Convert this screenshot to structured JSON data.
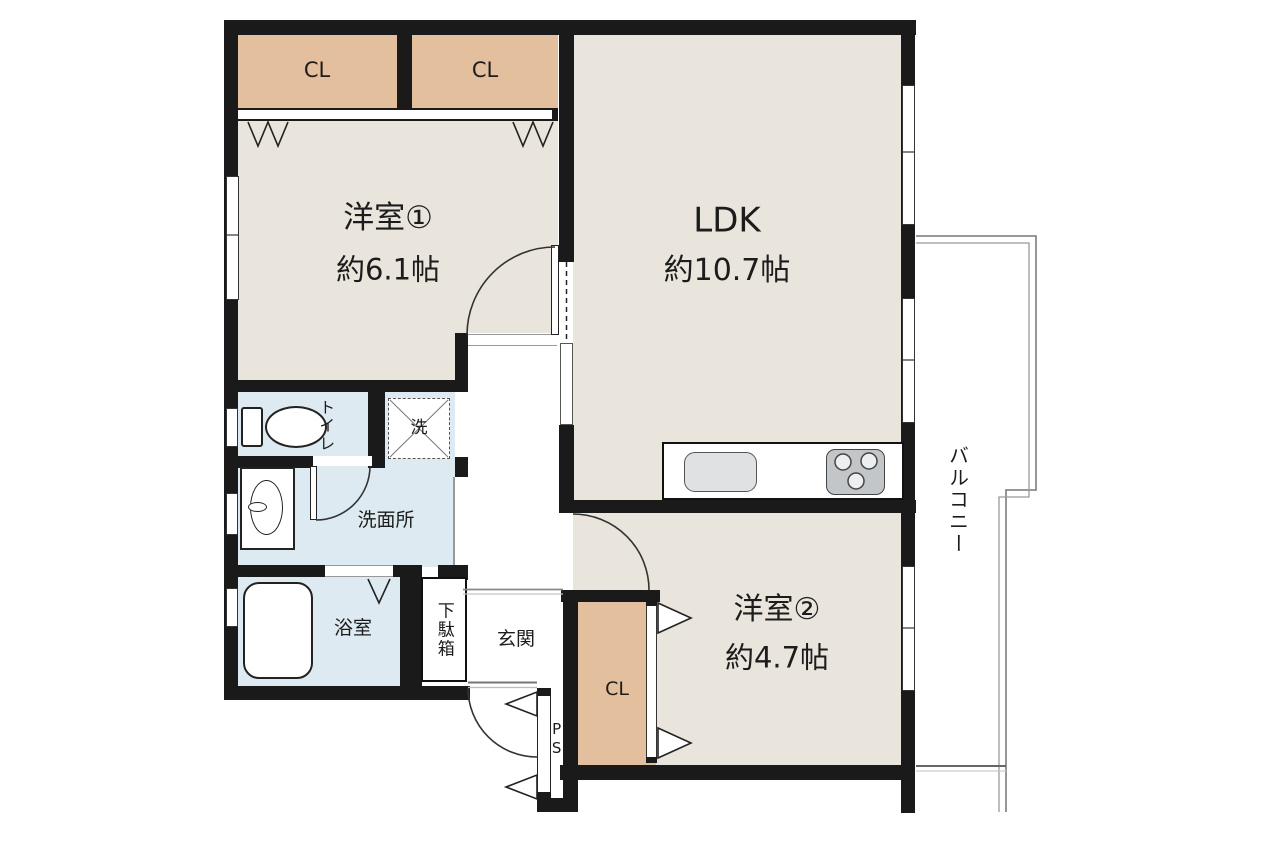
{
  "plan": {
    "rooms": {
      "yoshitsu1": {
        "name": "洋室①",
        "size": "約6.1帖"
      },
      "ldk": {
        "name": "LDK",
        "size": "約10.7帖"
      },
      "yoshitsu2": {
        "name": "洋室②",
        "size": "約4.7帖"
      },
      "toilet": {
        "name": "トイレ"
      },
      "washroom": {
        "name": "洗面所"
      },
      "bathroom": {
        "name": "浴室"
      },
      "entrance": {
        "name": "玄関"
      },
      "balcony": {
        "name": "バルコニー"
      }
    },
    "storage": {
      "closet1": "CL",
      "closet2": "CL",
      "closet3": "CL",
      "shoe_cabinet": "下駄箱",
      "pipe_space": "PS",
      "washer_pan": "洗"
    },
    "colors": {
      "floor": "#e9e4dc",
      "closet": "#e4bf9e",
      "wet_area": "#ddeaf1",
      "wall": "#1a1a1a",
      "balcony_line": "#8a8a8a",
      "appliance": "#c3c6c9",
      "sink": "#dfe1e3"
    }
  }
}
